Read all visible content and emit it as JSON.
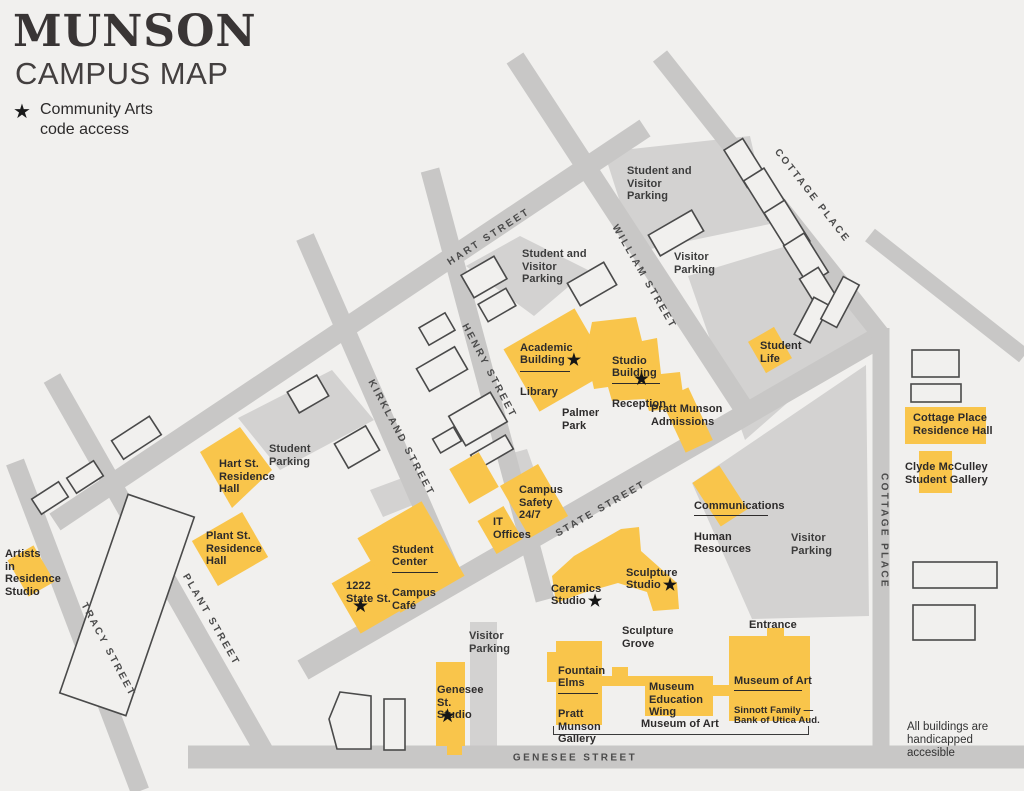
{
  "title": {
    "line1": "MUNSON",
    "line2": "CAMPUS MAP"
  },
  "legend": {
    "star": "★",
    "text": "Community Arts\ncode access"
  },
  "icons": {
    "star": "★"
  },
  "colors": {
    "building_yellow": "#f9c54b",
    "street_gray": "#c8c7c6",
    "parking_gray": "#d3d2d1",
    "background": "#f1f0ee",
    "outline": "#4a4a4a",
    "text": "#2d2b2b"
  },
  "streets": {
    "hart": "HART STREET",
    "william": "WILLIAM STREET",
    "henry": "HENRY STREET",
    "kirkland": "KIRKLAND STREET",
    "state": "STATE STREET",
    "tracy": "TRACY STREET",
    "plant": "PLANT STREET",
    "cottage_top": "COTTAGE PLACE",
    "cottage_right": "COTTAGE PLACE",
    "genesee": "GENESEE STREET"
  },
  "parking": {
    "p1": "Student and\nVisitor\nParking",
    "p2": "Visitor\nParking",
    "p3": "Student and\nVisitor\nParking",
    "p4": "Student\nParking",
    "p5": "Visitor\nParking",
    "p6": "Visitor\nParking"
  },
  "buildings": {
    "academic": {
      "name": "Academic\nBuilding",
      "sub": "Library"
    },
    "studio": {
      "name": "Studio\nBuilding",
      "sub": "Reception"
    },
    "student_life": {
      "name": "Student\nLife"
    },
    "cottage_place_hall": {
      "name": "Cottage Place\nResidence Hall"
    },
    "clyde_mcculley": {
      "name": "Clyde McCulley\nStudent Gallery"
    },
    "hart_residence": {
      "name": "Hart St.\nResidence\nHall"
    },
    "plant_residence": {
      "name": "Plant St.\nResidence\nHall"
    },
    "artists_in_residence": {
      "name": "Artists\nin\nResidence\nStudio"
    },
    "student_center": {
      "name": "Student\nCenter",
      "sub": "Campus\nCafé"
    },
    "state_1222": {
      "name": "1222\nState St."
    },
    "campus_safety": {
      "name": "Campus\nSafety\n24/7"
    },
    "it_offices": {
      "name": "IT\nOffices"
    },
    "ceramics": {
      "name": "Ceramics\nStudio"
    },
    "sculpture": {
      "name": "Sculpture\nStudio"
    },
    "communications": {
      "name": "Communications",
      "sub": "Human\nResources"
    },
    "fountain_elms": {
      "name": "Fountain\nElms",
      "sub": "Pratt\nMunson\nGallery"
    },
    "education_wing": {
      "name": "Museum\nEducation\nWing"
    },
    "museum_of_art": {
      "name": "Museum of Art",
      "sub": "Sinnott Family —\nBank of Utica Aud."
    },
    "genesee_studio": {
      "name": "Genesee\nSt.\nStudio"
    },
    "admissions": {
      "name": "Pratt Munson\nAdmissions"
    }
  },
  "areas": {
    "palmer_park": "Palmer\nPark",
    "sculpture_grove": "Sculpture\nGrove",
    "entrance": "Entrance",
    "museum_bracket": "Museum of Art"
  },
  "note": "All buildings are\nhandicapped\naccesible"
}
